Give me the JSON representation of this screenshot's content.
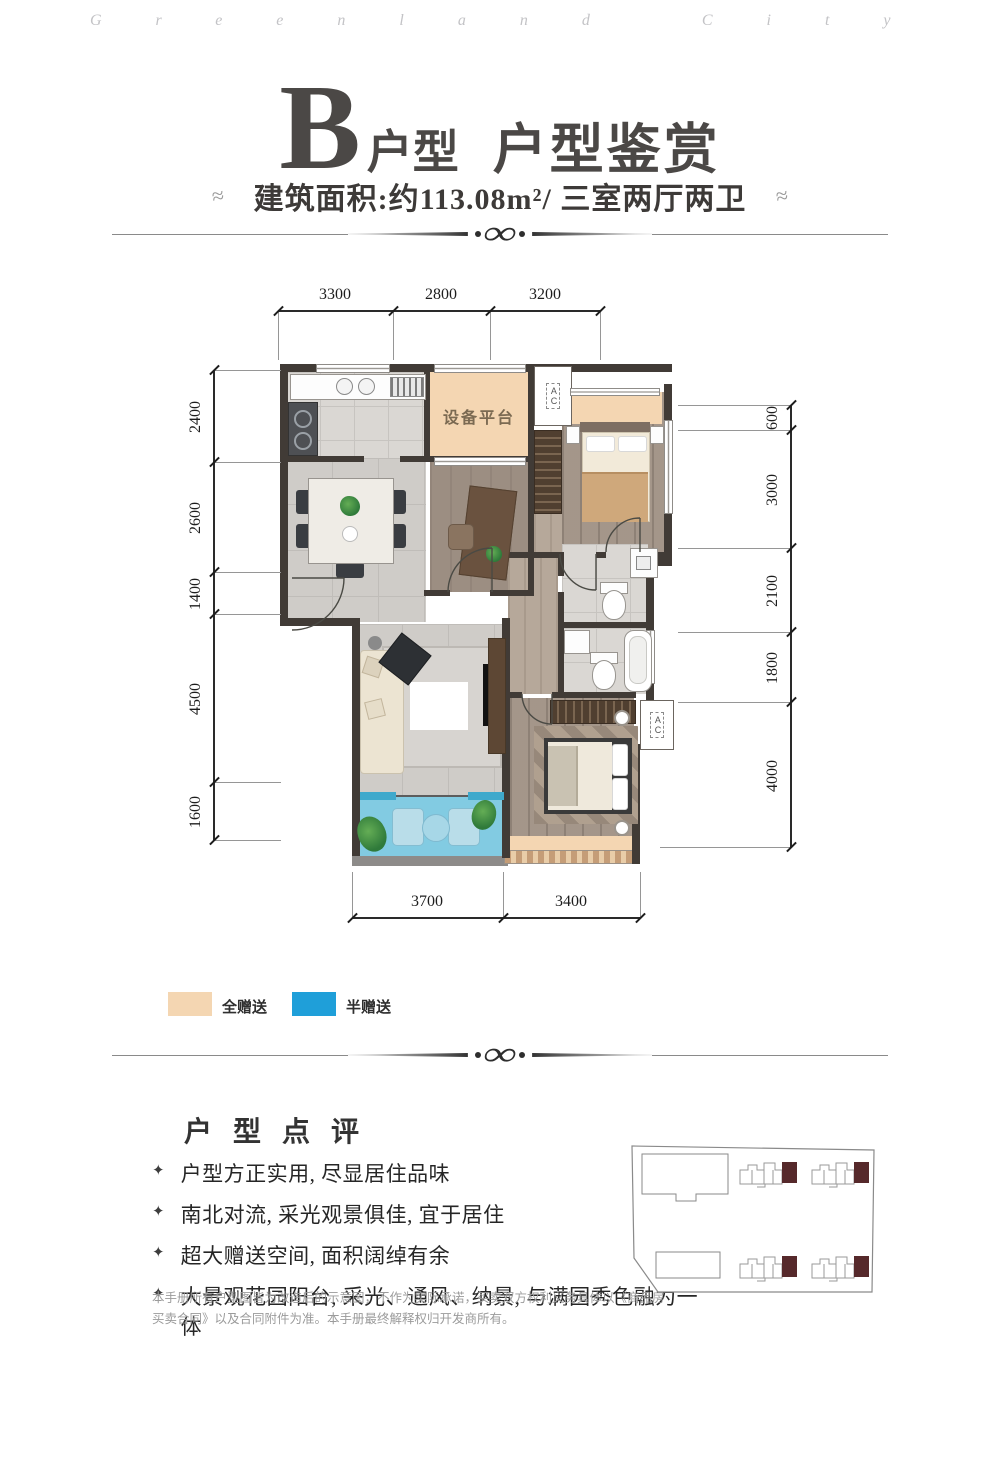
{
  "watermark": "Greenland City",
  "header": {
    "unit_letter": "B",
    "unit_type_label": "户型",
    "title": "户型鉴赏",
    "subtitle": "建筑面积:约113.08m²/ 三室两厅两卫"
  },
  "plan": {
    "labels": {
      "equipment_platform": "设备平台",
      "ac_unit": "AC"
    },
    "dims": {
      "top": [
        "3300",
        "2800",
        "3200"
      ],
      "left": [
        "2400",
        "2600",
        "1400",
        "4500",
        "1600"
      ],
      "right": [
        "600",
        "3000",
        "2100",
        "1800",
        "4000"
      ],
      "bottom": [
        "3700",
        "3400"
      ]
    }
  },
  "legend": {
    "items": [
      {
        "label": "全赠送",
        "color": "#f4d6b2"
      },
      {
        "label": "半赠送",
        "color": "#1f9fd9"
      }
    ]
  },
  "review": {
    "heading": "户 型 点 评",
    "bullets": [
      "户型方正实用, 尽显居住品味",
      "南北对流, 采光观景俱佳, 宜于居住",
      "超大赠送空间, 面积阔绰有余",
      "大景观花园阳台, 采光、通风、纳景, 与满园秀色融为一体"
    ],
    "disclaimer": "本手册所有户型图皆为改造后的示意图，不作为实际承诺，买卖双方权利义务具体以《商品房买卖合同》以及合同附件为准。本手册最终解释权归开发商所有。"
  },
  "colors": {
    "full_gift": "#f4d6b2",
    "half_gift": "#1f9fd9",
    "wall": "#413b36",
    "highlight_unit": "#56292b"
  }
}
